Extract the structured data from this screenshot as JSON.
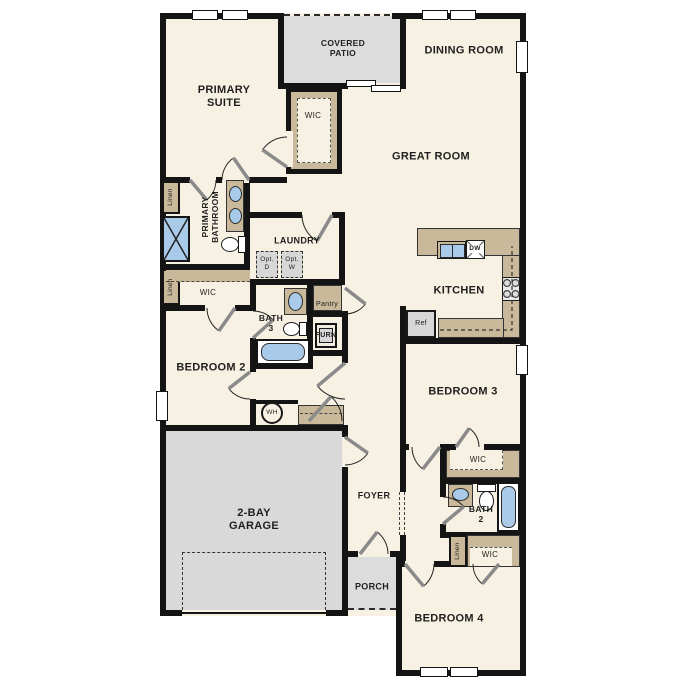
{
  "title": "Single-story floor plan",
  "colors": {
    "wall": "#141414",
    "floor": "#f7f1e3",
    "tan": "#c9b899",
    "outdoor_gray": "#dcdcdc",
    "garage_gray": "#d9d9d9",
    "fixture_blue": "#a9cbe9",
    "appliance_gray": "#d7d7d7",
    "label": "#1f1f1f"
  },
  "labels": {
    "primary_suite": "PRIMARY\nSUITE",
    "covered_patio": "COVERED\nPATIO",
    "dining_room": "DINING ROOM",
    "great_room": "GREAT ROOM",
    "wic_primary": "WIC",
    "primary_bathroom": "PRIMARY\nBATHROOM",
    "linen_primary_bath": "Linen",
    "linen_primary_wic": "Linen",
    "wic_primary2": "WIC",
    "laundry": "LAUNDRY",
    "opt_dryer": "Opt.\nD",
    "opt_washer": "Opt.\nW",
    "pantry": "Pantry",
    "bath3": "BATH\n3",
    "furnace": "FURN",
    "kitchen": "KITCHEN",
    "dishwasher": "DW",
    "refrigerator": "Ref",
    "bedroom2": "BEDROOM 2",
    "bedroom3": "BEDROOM 3",
    "water_heater": "WH",
    "garage": "2-BAY\nGARAGE",
    "foyer": "FOYER",
    "porch": "PORCH",
    "wic_bedroom3": "WIC",
    "bath2": "BATH\n2",
    "linen_bedroom4": "Linen",
    "wic_bedroom4": "WIC",
    "bedroom4": "BEDROOM 4"
  }
}
